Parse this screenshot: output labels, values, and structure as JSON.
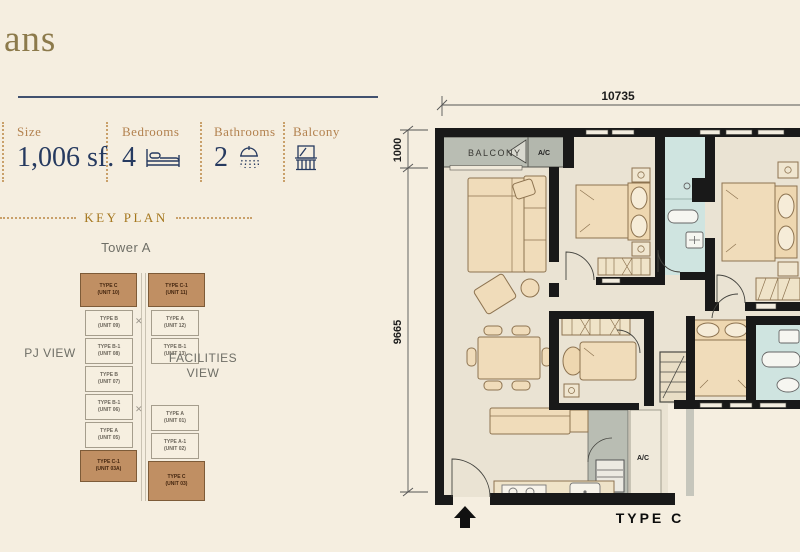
{
  "page": {
    "title_fragment": "ans"
  },
  "specs": {
    "items": [
      {
        "label": "Size",
        "value": "1,006 sf."
      },
      {
        "label": "Bedrooms",
        "value": "4"
      },
      {
        "label": "Bathrooms",
        "value": "2"
      },
      {
        "label": "Balcony",
        "value": ""
      }
    ]
  },
  "keyplan": {
    "heading": "KEY PLAN",
    "tower_label": "Tower A",
    "left_view_label": "PJ VIEW",
    "right_view_line1": "FACILITIES",
    "right_view_line2": "VIEW",
    "left_column": [
      {
        "type": "TYPE C",
        "unit": "(UNIT 10)",
        "highlight": true
      },
      {
        "type": "TYPE B",
        "unit": "(UNIT 09)",
        "highlight": false
      },
      {
        "type": "TYPE B-1",
        "unit": "(UNIT 08)",
        "highlight": false
      },
      {
        "type": "TYPE B",
        "unit": "(UNIT 07)",
        "highlight": false
      },
      {
        "type": "TYPE B-1",
        "unit": "(UNIT 06)",
        "highlight": false
      },
      {
        "type": "TYPE A",
        "unit": "(UNIT 05)",
        "highlight": false
      },
      {
        "type": "TYPE C-1",
        "unit": "(UNIT 03A)",
        "highlight": true
      }
    ],
    "right_column": [
      {
        "type": "TYPE C-1",
        "unit": "(UNIT 11)",
        "highlight": true
      },
      {
        "type": "TYPE A",
        "unit": "(UNIT 12)",
        "highlight": false
      },
      {
        "type": "TYPE B-1",
        "unit": "(UNIT 13)",
        "highlight": false
      },
      {
        "type": "TYPE A",
        "unit": "(UNIT 01)",
        "highlight": false
      },
      {
        "type": "TYPE A-1",
        "unit": "(UNIT 02)",
        "highlight": false
      },
      {
        "type": "TYPE C",
        "unit": "(UNIT 03)",
        "highlight": true
      }
    ]
  },
  "floorplan": {
    "type_label": "TYPE C",
    "balcony_label": "BALCONY",
    "ac_top_label": "A/C",
    "ac_bottom_label": "A/C",
    "width_dim": "10735",
    "balcony_depth_dim": "1000",
    "height_dim": "9665"
  },
  "colors": {
    "background": "#f5eee0",
    "accent_gold": "#b3824f",
    "navy": "#263a60",
    "wall_black": "#191919",
    "floor": "#eae3d3",
    "furniture": "#f0dcba",
    "bathroom": "#cfe4e0",
    "balcony_gray": "#b9bdb3",
    "keyplan_highlight": "#c08f63"
  }
}
